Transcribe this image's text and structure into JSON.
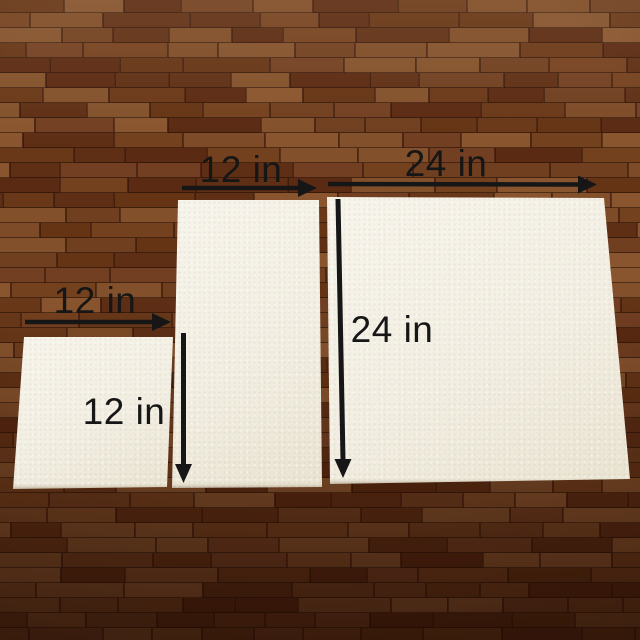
{
  "annotations": {
    "small_board": {
      "width": "12 in",
      "height": "12 in"
    },
    "medium_board": {
      "width": "12 in"
    },
    "large_board": {
      "width": "24 in",
      "height": "24 in"
    }
  },
  "colors": {
    "annotation_text": "#161616",
    "board_surface": "#f2eee2",
    "floor_seam": "#2a1206",
    "floor_palette": [
      "#74411f",
      "#7d4b27",
      "#693819",
      "#82512c",
      "#5e2f15",
      "#6f3f20",
      "#89552f",
      "#643415",
      "#723f22",
      "#5a2a12"
    ]
  }
}
